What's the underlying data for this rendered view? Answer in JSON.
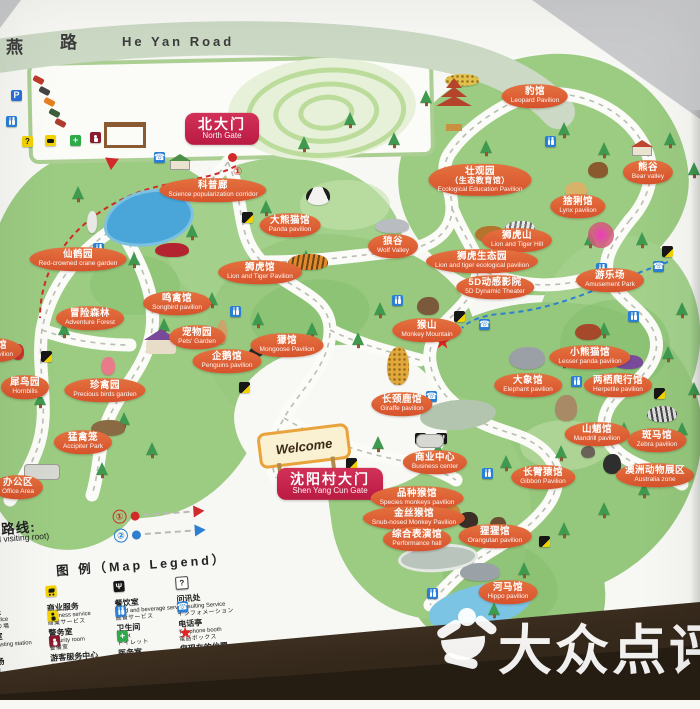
{
  "photo": {
    "watermark": "大众点评"
  },
  "road": {
    "cn_left": "燕",
    "cn_right": "路",
    "en": "He Yan Road"
  },
  "map": {
    "welcome_sign": "Welcome",
    "route_start_marker": "①",
    "labels": [
      {
        "n": "north-gate",
        "t": "g",
        "cn": "北大门",
        "en": "North Gate",
        "x": 222,
        "y": 129
      },
      {
        "n": "shenyangcun-gate",
        "t": "g",
        "cn": "沈阳村大门",
        "en": "Shen Yang Cun Gate",
        "x": 330,
        "y": 484
      },
      {
        "n": "science-corridor",
        "cn": "科普廊",
        "en": "Science popularization corridor",
        "x": 213,
        "y": 190
      },
      {
        "n": "panda-pavilion",
        "cn": "大熊猫馆",
        "en": "Panda pavilion",
        "x": 290,
        "y": 225
      },
      {
        "n": "crane-garden",
        "cn": "仙鹤园",
        "en": "Red-crowned crane garden",
        "x": 78,
        "y": 259
      },
      {
        "n": "songbird-pavilion",
        "cn": "鸣禽馆",
        "en": "Songbird pavilion",
        "x": 177,
        "y": 303
      },
      {
        "n": "adventure-forest",
        "cn": "冒险森林",
        "en": "Adventure Forest",
        "x": 90,
        "y": 318
      },
      {
        "n": "pets-garden",
        "cn": "宠物园",
        "en": "Pets' Garden",
        "x": 197,
        "y": 337
      },
      {
        "n": "penguins-pavilion",
        "cn": "企鹅馆",
        "en": "Penguins pavilion",
        "x": 227,
        "y": 361
      },
      {
        "n": "mongoose-pavilion",
        "cn": "獴馆",
        "en": "Mongoose Pavilion",
        "x": 287,
        "y": 345
      },
      {
        "n": "lion-tiger-pavilion",
        "cn": "狮虎馆",
        "en": "Lion and Tiger Pavilion",
        "x": 260,
        "y": 272
      },
      {
        "n": "wolf-valley",
        "cn": "狼谷",
        "en": "Wolf Valley",
        "x": 393,
        "y": 246
      },
      {
        "n": "parrot-pavilion",
        "cn": "鹦鹉馆",
        "en": "Parrot Pavilion",
        "x": -8,
        "y": 350
      },
      {
        "n": "hornbills",
        "cn": "犀鸟园",
        "en": "Hornbills",
        "x": 25,
        "y": 387
      },
      {
        "n": "precious-birds-garden",
        "cn": "珍禽园",
        "en": "Precious birds garden",
        "x": 105,
        "y": 390
      },
      {
        "n": "accipiter-park",
        "cn": "猛禽笼",
        "en": "Accipiter Park",
        "x": 83,
        "y": 442
      },
      {
        "n": "office-area",
        "cn": "办公区",
        "en": "Office Area",
        "x": 18,
        "y": 487
      },
      {
        "n": "leopard-pavilion",
        "cn": "豹馆",
        "en": "Leopard Pavilion",
        "x": 535,
        "y": 96
      },
      {
        "n": "ecological-education-pavilion",
        "cn": "壮观园",
        "cn2": "（生态教育馆）",
        "en": "Ecological Education Pavilion",
        "x": 480,
        "y": 180
      },
      {
        "n": "bear-valley",
        "cn": "熊谷",
        "en": "Bear valley",
        "x": 648,
        "y": 172
      },
      {
        "n": "lynx-pavilion",
        "cn": "猞猁馆",
        "en": "Lynx pavilion",
        "x": 578,
        "y": 206
      },
      {
        "n": "lion-tiger-hill",
        "cn": "狮虎山",
        "en": "Lion and Tiger Hill",
        "x": 517,
        "y": 240
      },
      {
        "n": "lion-tiger-ecological-garden",
        "cn": "狮虎生态园",
        "en": "Lion and tiger ecological pavilion",
        "x": 482,
        "y": 261
      },
      {
        "n": "amusement-park",
        "cn": "游乐场",
        "en": "Amusement Park",
        "x": 610,
        "y": 280
      },
      {
        "n": "5d-dynamic-theater",
        "cn": "5D动感影院",
        "en": "5D Dynamic Theater",
        "x": 495,
        "y": 287
      },
      {
        "n": "monkey-mountain",
        "cn": "猴山",
        "en": "Monkey Mountain",
        "x": 427,
        "y": 330
      },
      {
        "n": "lesser-panda-pavilion",
        "cn": "小熊猫馆",
        "en": "Lesser panda pavilion",
        "x": 590,
        "y": 357
      },
      {
        "n": "herpetile-pavilion",
        "cn": "两栖爬行馆",
        "en": "Herpetile pavilion",
        "x": 618,
        "y": 385
      },
      {
        "n": "elephant-pavilion",
        "cn": "大象馆",
        "en": "Elephant pavilion",
        "x": 528,
        "y": 385
      },
      {
        "n": "giraffe-pavilion",
        "cn": "长颈鹿馆",
        "en": "Giraffe pavilion",
        "x": 402,
        "y": 404
      },
      {
        "n": "business-center",
        "cn": "商业中心",
        "en": "Business center",
        "x": 435,
        "y": 462
      },
      {
        "n": "gibbon-pavilion",
        "cn": "长臂猿馆",
        "en": "Gibbon Pavilion",
        "x": 543,
        "y": 477
      },
      {
        "n": "mandrill-pavilion",
        "cn": "山魈馆",
        "en": "Mandrill pavilion",
        "x": 597,
        "y": 434
      },
      {
        "n": "zebra-pavilion",
        "cn": "斑马馆",
        "en": "Zebra pavilion",
        "x": 657,
        "y": 440
      },
      {
        "n": "australia-zone",
        "cn": "澳洲动物展区",
        "en": "Australia zone",
        "x": 655,
        "y": 475
      },
      {
        "n": "species-monkeys-pavilion",
        "cn": "品种猴馆",
        "en": "Species monkeys pavilion",
        "x": 417,
        "y": 498
      },
      {
        "n": "snub-nosed-monkey-pavilion",
        "cn": "金丝猴馆",
        "en": "Snub-nosed Monkey Pavilion",
        "x": 414,
        "y": 518
      },
      {
        "n": "performance-hall",
        "cn": "综合表演馆",
        "en": "Performance hall",
        "x": 417,
        "y": 539
      },
      {
        "n": "orangutan-pavilion",
        "cn": "猩猩馆",
        "en": "Orangutan pavilion",
        "x": 495,
        "y": 536
      },
      {
        "n": "hippo-pavilion",
        "cn": "河马馆",
        "en": "Hippo pavilion",
        "x": 508,
        "y": 592
      }
    ]
  },
  "legend": {
    "title_cn": "推荐游览路线:",
    "title_en": "(recommended visiting root)",
    "title_jp": "遊覧コース",
    "header": "图 例（Map Legend）",
    "routes": [
      {
        "num": "①",
        "color": "#d02a2a"
      },
      {
        "num": "②",
        "color": "#2d7fd2"
      }
    ],
    "items": [
      {
        "icon": "ticket",
        "cn": "售票处",
        "en": "Ticket office",
        "jp": "切符売り場"
      },
      {
        "icon": "broadcast",
        "cn": "广播室",
        "en": "Broadcasting station",
        "jp": "放送室"
      },
      {
        "icon": "parking",
        "cn": "停车场",
        "en": "Parking",
        "jp": "駐車場"
      },
      {
        "icon": "cart",
        "cn": "商业服务",
        "en": "Business service",
        "jp": "商業サービス"
      },
      {
        "icon": "security",
        "cn": "警务室",
        "en": "Security room",
        "jp": "警備室"
      },
      {
        "icon": "guide",
        "cn": "游客服务中心",
        "en": "Guests' Service Center",
        "jp": "観光サービスセンター"
      },
      {
        "icon": "food",
        "cn": "餐饮室",
        "en": "Food and beverage service",
        "jp": "飲食サービス"
      },
      {
        "icon": "toilet",
        "cn": "卫生间",
        "en": "Toilet",
        "jp": "トイレット"
      },
      {
        "icon": "medical",
        "cn": "医务室",
        "en": "Medication center",
        "jp": "医療サービス"
      },
      {
        "icon": "infow",
        "cn": "问讯处",
        "en": "Consulting Service",
        "jp": "インフォメーション"
      },
      {
        "icon": "phone",
        "cn": "电话亭",
        "en": "Telephone booth",
        "jp": "電話ボックス"
      },
      {
        "icon": "star",
        "cn": "您现在的位置",
        "en": "You are here",
        "jp": "現在地"
      }
    ]
  }
}
